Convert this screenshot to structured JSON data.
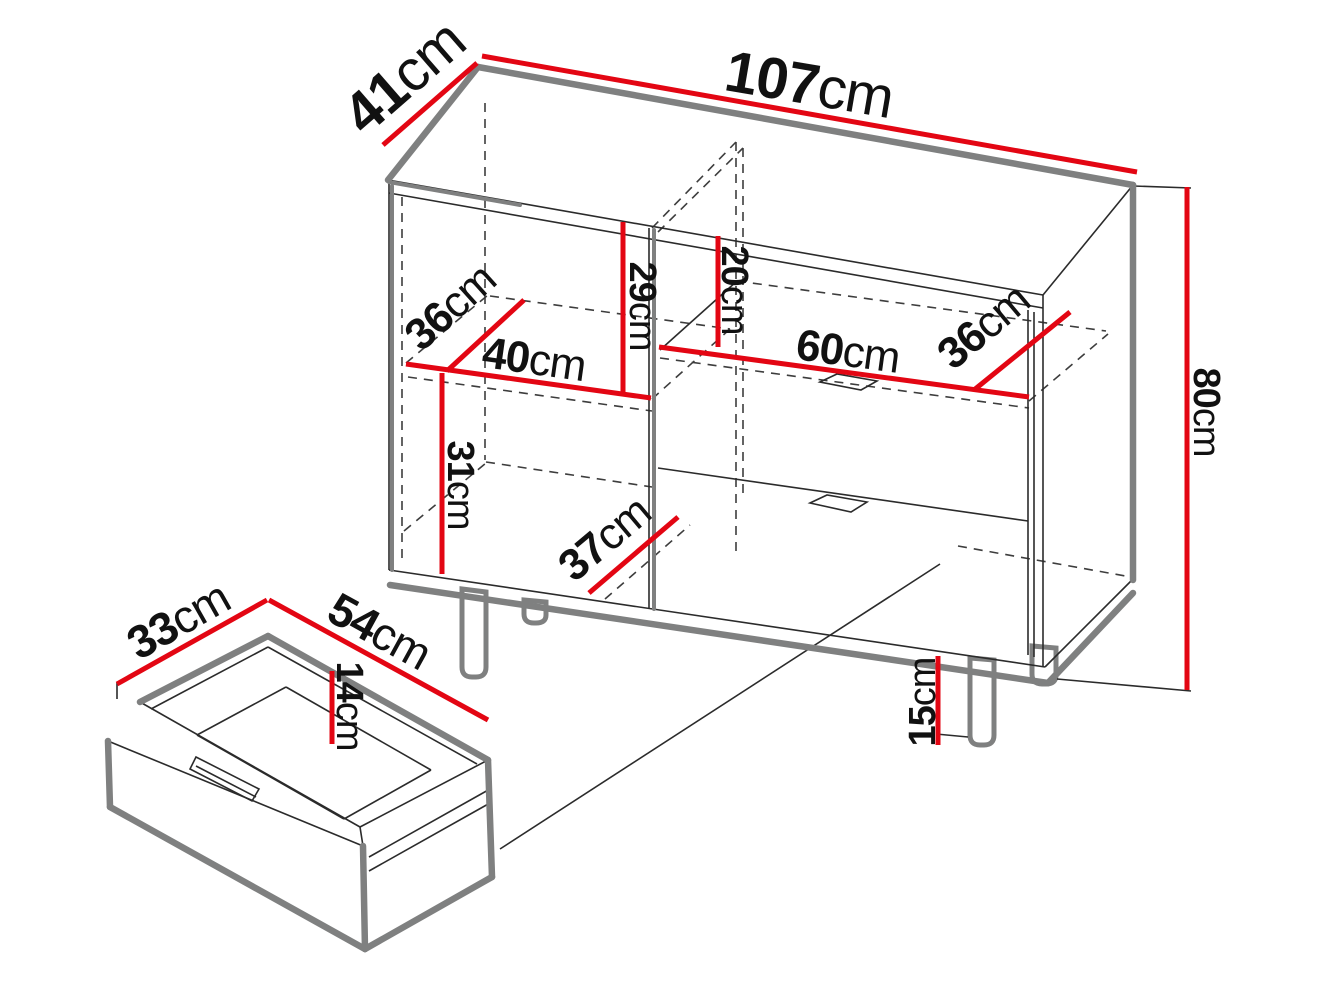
{
  "diagram": {
    "background": "#ffffff",
    "colors": {
      "dimension_line": "#e30613",
      "edge_shadow": "#7f8080",
      "outline": "#2b2b2b",
      "label": "#111111"
    },
    "cabinet": {
      "width": {
        "value": "107",
        "unit": "cm"
      },
      "depth": {
        "value": "41",
        "unit": "cm"
      },
      "height": {
        "value": "80",
        "unit": "cm"
      },
      "left_upper_compartment_height": {
        "value": "29",
        "unit": "cm"
      },
      "right_upper_gap_height": {
        "value": "20",
        "unit": "cm"
      },
      "left_shelf_depth": {
        "value": "36",
        "unit": "cm"
      },
      "left_shelf_width": {
        "value": "40",
        "unit": "cm"
      },
      "right_compartment_width": {
        "value": "60",
        "unit": "cm"
      },
      "right_shelf_depth": {
        "value": "36",
        "unit": "cm"
      },
      "left_lower_compartment_height": {
        "value": "31",
        "unit": "cm"
      },
      "bottom_depth": {
        "value": "37",
        "unit": "cm"
      },
      "leg_height": {
        "value": "15",
        "unit": "cm"
      }
    },
    "drawer": {
      "depth": {
        "value": "33",
        "unit": "cm"
      },
      "width": {
        "value": "54",
        "unit": "cm"
      },
      "inner_height": {
        "value": "14",
        "unit": "cm"
      }
    }
  }
}
